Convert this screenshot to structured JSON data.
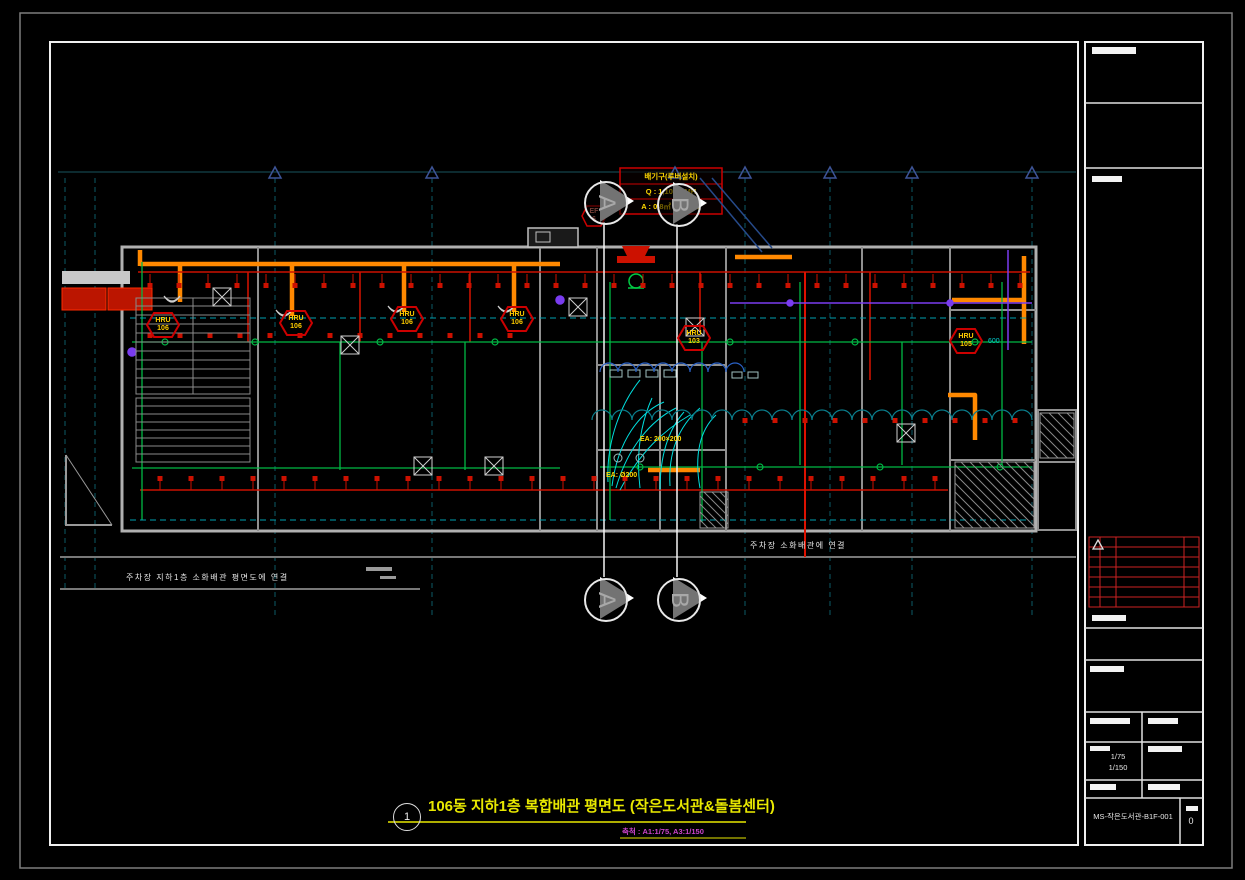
{
  "plan": {
    "sections": {
      "a": "A",
      "b": "B"
    },
    "exhaust_box": {
      "line1": "배기구(루버설치)",
      "line2": "Q : 1,100 CMH",
      "line3": "A : 0.8㎡ 이상필요"
    },
    "notes": {
      "parking_left": "주차장 지하1층 소화배관 평면도에 연결",
      "parking_right": "주차장 소화배관에 연결",
      "size_a": "EA: 200×200",
      "size_b": "EA: Ø200",
      "dim_600": "600"
    },
    "ef_tag": {
      "name": "EF",
      "num": "6"
    },
    "hru_tags": [
      {
        "name": "HRU",
        "num": "106"
      },
      {
        "name": "HRU",
        "num": "106"
      },
      {
        "name": "HRU",
        "num": "106"
      },
      {
        "name": "HRU",
        "num": "106"
      },
      {
        "name": "HRU",
        "num": "103"
      },
      {
        "name": "HRU",
        "num": "105"
      }
    ]
  },
  "title": {
    "no": "1",
    "text": "106동 지하1층 복합배관 평면도 (작은도서관&돌봄센터)",
    "scale": "축척 : A1:1/75, A3:1/150"
  },
  "title_block": {
    "scale_1": "1/75",
    "scale_2": "1/150",
    "dwg_no": "MS-작은도서관-B1F-001",
    "rev": "0"
  },
  "colors": {
    "duct_orange": "#ff8800",
    "pipe_red": "#cc1100",
    "pipe_green": "#00b844",
    "grid_teal": "#0c5a66",
    "tag_yellow": "#ffcc00",
    "title_yellow": "#e8e800",
    "scale_magenta": "#cc44cc",
    "cyan_pipe": "#00dede",
    "purple_pipe": "#7a3cf0"
  }
}
